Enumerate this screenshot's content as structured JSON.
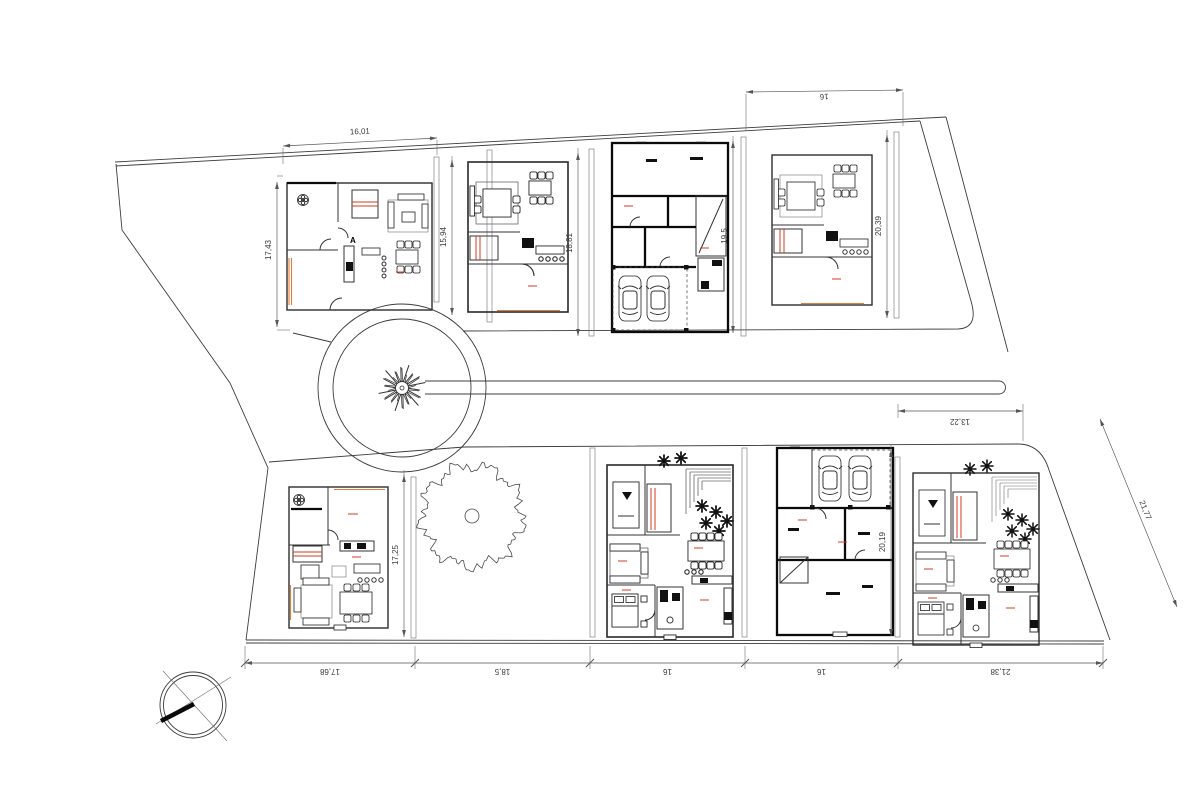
{
  "title": "Residential subdivision site plan with villa floor plans",
  "colors": {
    "paper": "#ffffff",
    "line": "#3c3c3c",
    "bold_wall": "#0a0a0a",
    "dimension": "#3a3a3a",
    "accent_red": "#d23b1e",
    "accent_orange": "#e07d3a"
  },
  "dimensions": {
    "lot1_width": "16,01",
    "lot1_height_left": "17,43",
    "lot1_height_right": "15,94",
    "lot2_height": "18,81",
    "lot3_height": "19,5",
    "lot4_width": "16",
    "lot4_height": "20,39",
    "lot5_height": "17,25",
    "lot7_height": "20,19",
    "lot8_frontage": "13,22",
    "lot8_side": "21,77",
    "chain": [
      "17,68",
      "18,5",
      "16",
      "16",
      "21,38"
    ]
  },
  "markers": {
    "section_a": "A"
  }
}
